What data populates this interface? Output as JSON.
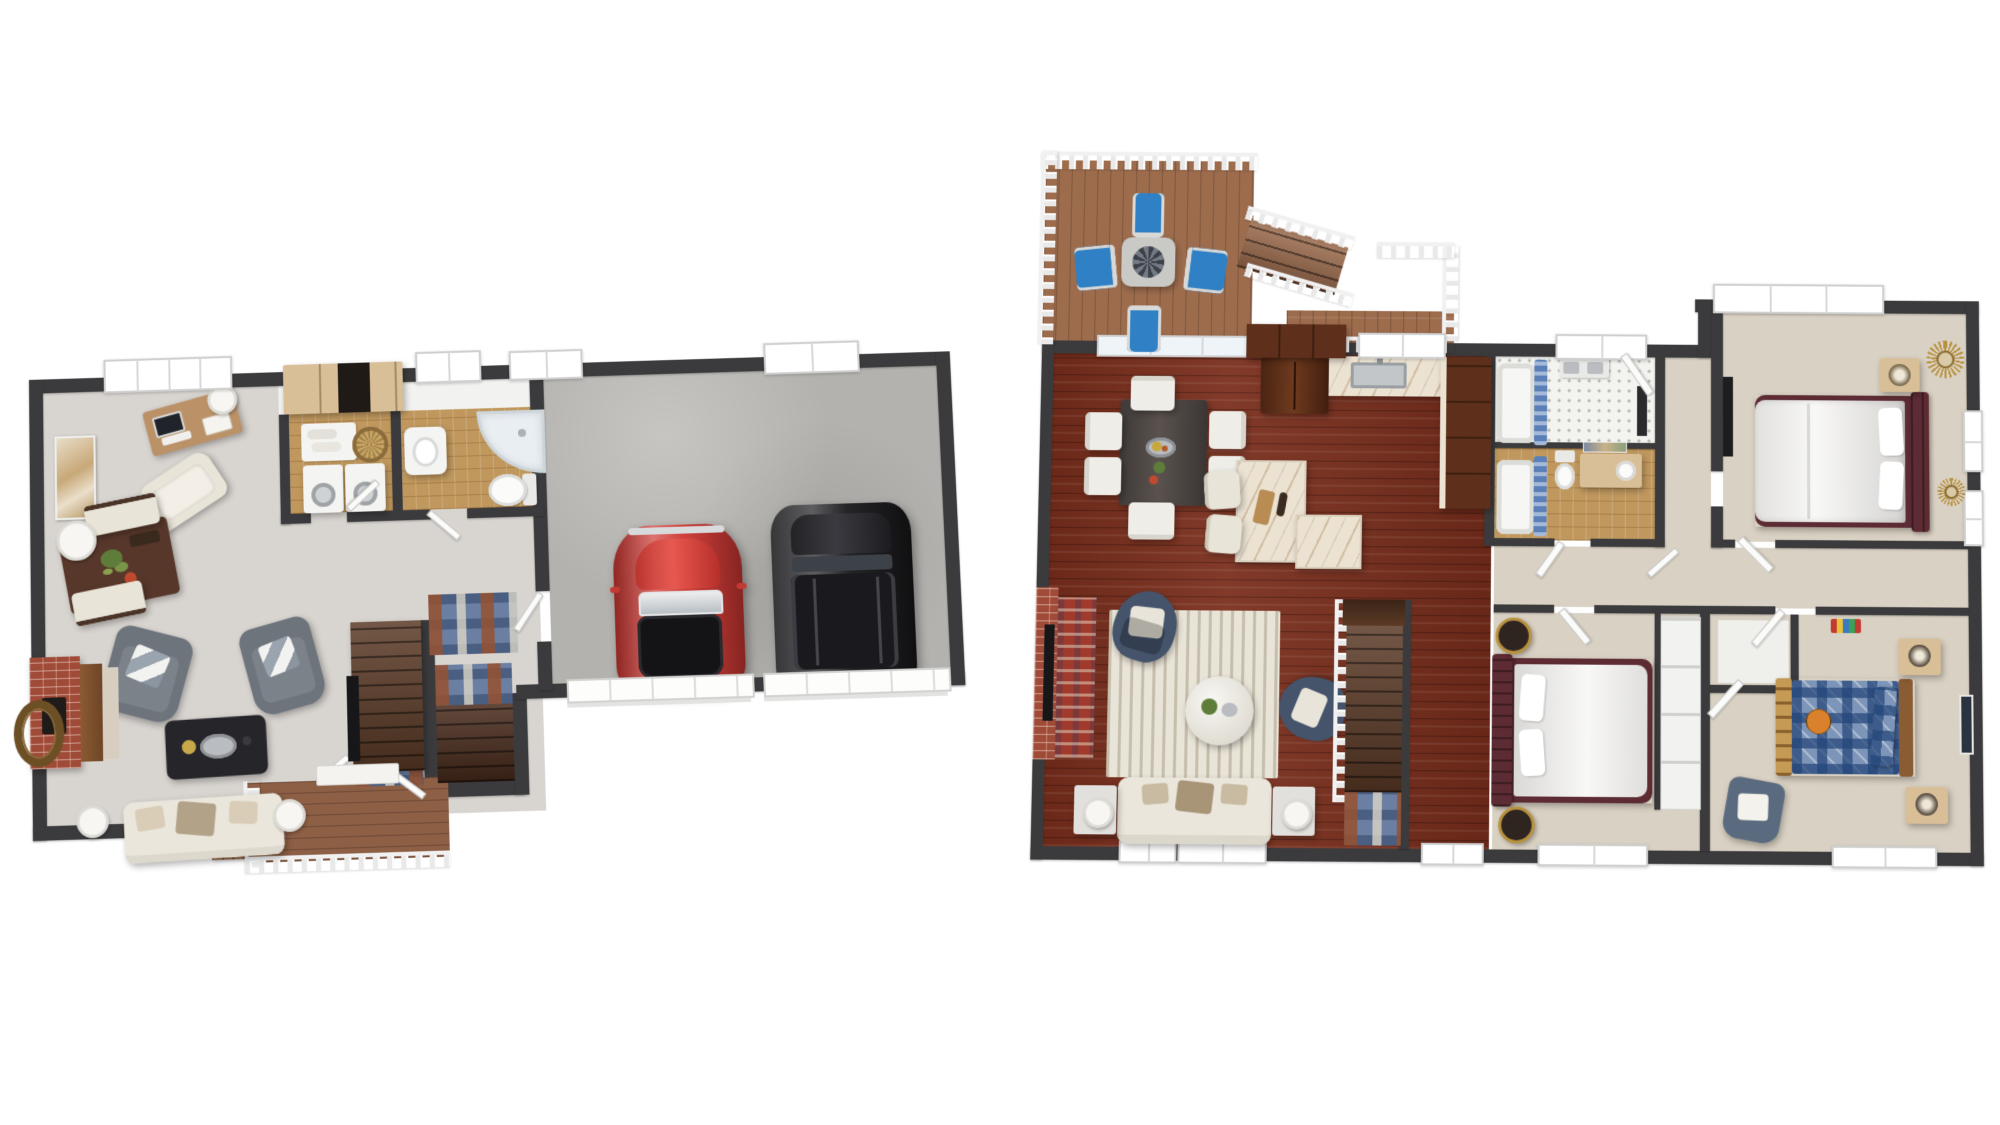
{
  "image": {
    "type": "3d-floor-plan-rendering",
    "background": "#ffffff",
    "views": [
      "first-floor",
      "second-floor"
    ]
  },
  "palette": {
    "wall": "#3b3b3d",
    "wall_face": "#f2f2f0",
    "carpet_gray": "#d8d4d0",
    "carpet_beige": "#d9d1c3",
    "concrete": "#b4b2ae",
    "tile_tan": "#c0985e",
    "tile_white": "#f3f3ef",
    "wood_floor": "#7a2e1c",
    "deck_wood": "#9d6c4d",
    "porch_wood": "#8d5f45",
    "stair_wood": "#5b3a26",
    "stair_dark": "#47291a",
    "marble": "#ebe2d2",
    "cabinet_dark": "#5e2f1a",
    "cabinet_tan": "#d8bf97",
    "brick": "#a04a38",
    "hearth_stone": "#d8cec0",
    "cream": "#e9e4d8",
    "sofa_cream": "#eae6dc",
    "gray_chair": "#6d747c",
    "navy_chair": "#45546b",
    "black_table": "#26262a",
    "maroon": "#5d2b33",
    "plaid_blue": "#7d95b8",
    "bed_white": "#f2f1ee",
    "blue_chair": "#2f80c4",
    "red_car": "#cf3732",
    "black_suv": "#202023",
    "rug_blue": "#6b7fa3",
    "rug_red": "#a03a2c",
    "umbrella_gray": "#5c636e",
    "gold": "#b8913f",
    "basketball": "#d9822b",
    "desk_wood": "#bb9268",
    "walnut": "#57372a",
    "appliance_white": "#f4f4f2"
  },
  "first_floor": {
    "name": "first-floor-plan",
    "rooms": [
      {
        "name": "den-dining",
        "furniture": [
          "desk-with-laptop",
          "desk-lamp",
          "lounge-chair",
          "wall-art",
          "dining-table",
          "bench",
          "bench",
          "drum-lamp"
        ]
      },
      {
        "name": "laundry-room",
        "furniture": [
          "upper-cabinets",
          "washer",
          "dryer",
          "folded-towels",
          "wicker-basket"
        ]
      },
      {
        "name": "bathroom",
        "furniture": [
          "pedestal-sink",
          "corner-shower",
          "toilet"
        ]
      },
      {
        "name": "living-room",
        "furniture": [
          "brick-fireplace",
          "tv",
          "armchair",
          "armchair",
          "coffee-table",
          "sofa",
          "table-lamp",
          "table-lamp",
          "wreath"
        ]
      },
      {
        "name": "hallway",
        "furniture": [
          "staircase-up",
          "staircase-down",
          "patterned-rug",
          "media-console"
        ]
      },
      {
        "name": "garage",
        "vehicles": [
          "red-classic-car",
          "black-suv"
        ],
        "features": [
          "garage-door",
          "garage-door"
        ]
      },
      {
        "name": "entry-porch",
        "features": [
          "wood-deck",
          "railing",
          "steps",
          "front-door"
        ]
      }
    ]
  },
  "second_floor": {
    "name": "second-floor-plan",
    "rooms": [
      {
        "name": "deck",
        "furniture": [
          "outdoor-table",
          "patio-umbrella",
          "deck-chair",
          "deck-chair",
          "deck-chair",
          "deck-chair"
        ],
        "features": [
          "railing",
          "deck-stairs",
          "balcony"
        ]
      },
      {
        "name": "dining-area",
        "furniture": [
          "dining-table",
          "dining-chair",
          "dining-chair",
          "dining-chair",
          "dining-chair",
          "dining-chair",
          "dining-chair"
        ],
        "features": [
          "sliding-glass-door"
        ]
      },
      {
        "name": "kitchen",
        "furniture": [
          "refrigerator",
          "upper-cabinets",
          "sink-counter",
          "cabinet-run",
          "marble-island",
          "stool",
          "stool"
        ]
      },
      {
        "name": "bathroom-1",
        "furniture": [
          "bathtub",
          "shower-curtain",
          "double-sink",
          "mirror"
        ]
      },
      {
        "name": "bathroom-2",
        "furniture": [
          "bathtub",
          "shower-curtain",
          "toilet",
          "vanity-sink"
        ]
      },
      {
        "name": "living-room",
        "furniture": [
          "brick-fireplace",
          "tv",
          "red-rug",
          "area-rug",
          "round-ottoman",
          "swivel-chair",
          "swivel-chair",
          "sofa",
          "side-table",
          "side-table",
          "table-lamp",
          "table-lamp"
        ]
      },
      {
        "name": "hallway",
        "features": [
          "doors",
          "stairwell-down",
          "runner-rug"
        ]
      },
      {
        "name": "master-bedroom",
        "furniture": [
          "upholstered-bed",
          "nightstand",
          "table-lamp",
          "sunburst-mirror",
          "sunburst-mirror",
          "tv-dresser"
        ]
      },
      {
        "name": "bedroom-2",
        "furniture": [
          "upholstered-bed",
          "round-nightstand",
          "round-nightstand",
          "closet-doors"
        ]
      },
      {
        "name": "bedroom-3",
        "furniture": [
          "plaid-bed",
          "basketball",
          "nightstand",
          "nightstand",
          "armchair",
          "wall-art",
          "striped-rug",
          "closet"
        ]
      }
    ]
  }
}
